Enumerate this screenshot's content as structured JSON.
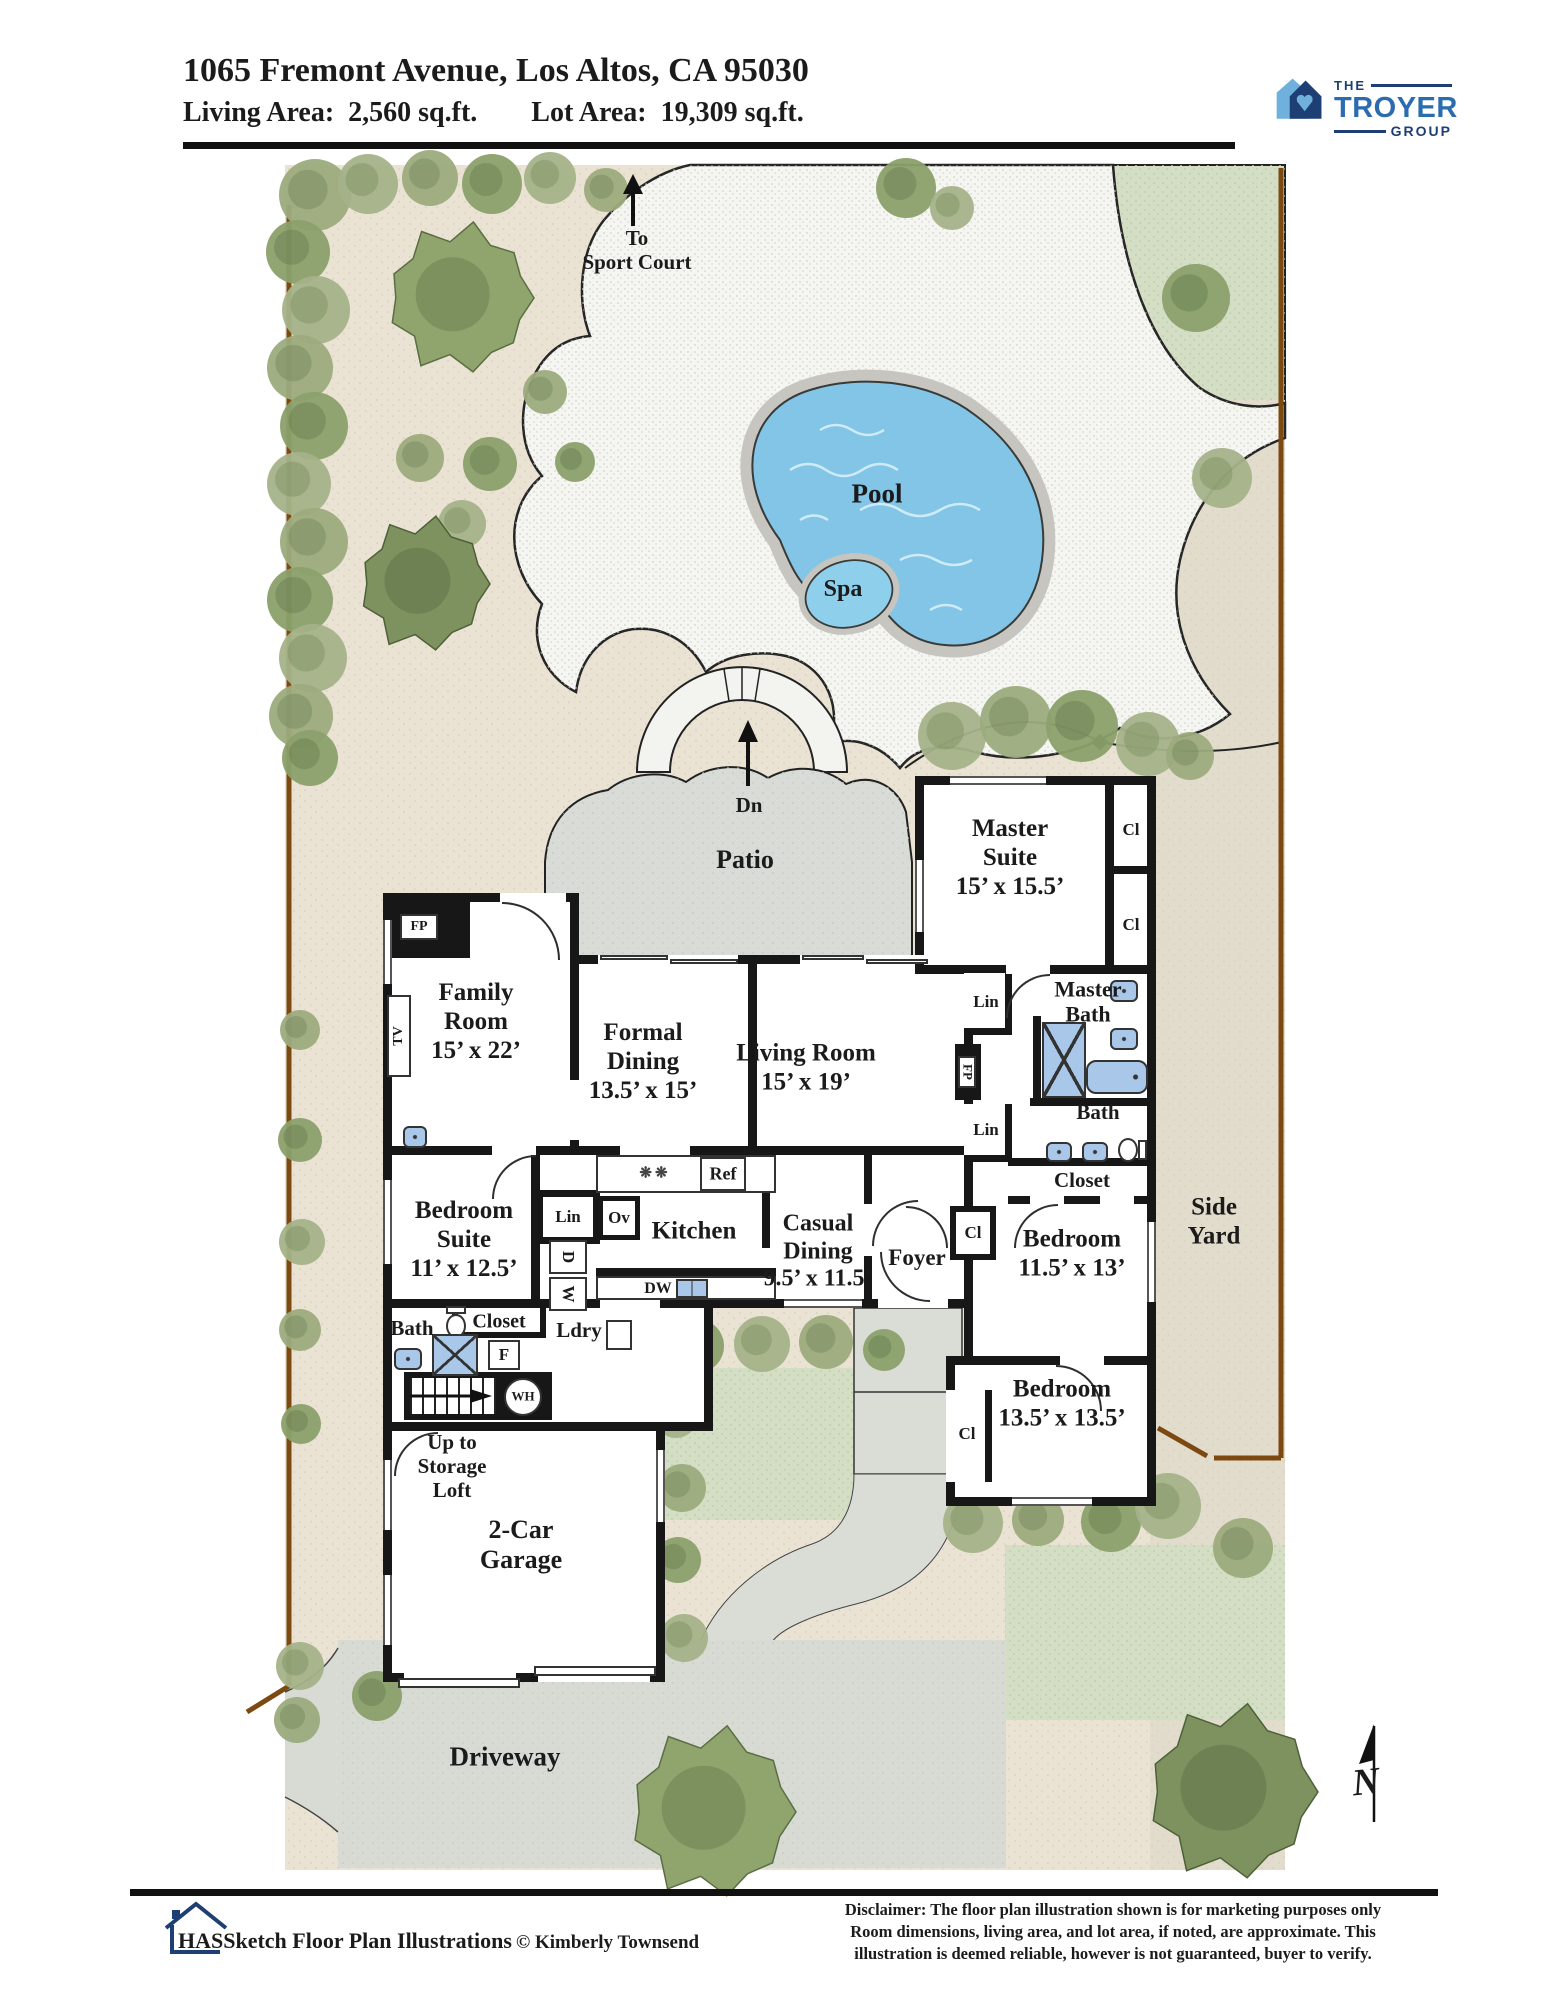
{
  "header": {
    "address": "1065 Fremont Avenue, Los Altos, CA 95030",
    "living_area_label": "Living Area:",
    "living_area_value": "2,560 sq.ft.",
    "lot_area_label": "Lot Area:",
    "lot_area_value": "19,309 sq.ft."
  },
  "logo": {
    "the": "THE",
    "troyer": "TROYER",
    "group": "GROUP"
  },
  "site": {
    "sport_court": "To\nSport Court",
    "pool": "Pool",
    "spa": "Spa",
    "patio": "Patio",
    "down": "Dn",
    "side_yard": "Side\nYard",
    "driveway": "Driveway",
    "north": "N"
  },
  "rooms": {
    "master_suite": "Master\nSuite\n15’ x 15.5’",
    "family_room": "Family\nRoom\n15’ x 22’",
    "formal_dining": "Formal\nDining\n13.5’ x 15’",
    "living_room": "Living Room\n15’ x 19’",
    "master_bath": "Master\nBath",
    "bedroom_1": "Bedroom\n11.5’ x 13’",
    "bedroom_2": "Bedroom\n13.5’ x 13.5’",
    "bedroom_suite": "Bedroom\nSuite\n11’ x 12.5’",
    "kitchen": "Kitchen",
    "casual_dining": "Casual\nDining\n9.5’ x 11.5’",
    "foyer": "Foyer",
    "laundry": "Ldry",
    "bath": "Bath",
    "closet": "Closet",
    "garage": "2-Car\nGarage",
    "storage_loft": "Up to\nStorage\nLoft"
  },
  "tags": {
    "cl": "Cl",
    "lin": "Lin",
    "fp": "FP",
    "tv": "TV",
    "ref": "Ref",
    "ov": "Ov",
    "washer": "W",
    "dryer": "D",
    "dw": "DW",
    "f": "F",
    "wh": "WH",
    "stove": "❋❋"
  },
  "colors": {
    "accent_blue_light": "#6fb0dc",
    "accent_blue_dark": "#1e3f74",
    "accent_blue_mid": "#2b6cb0",
    "pool_water": "#82c5e6",
    "lawn": "#d3dec5",
    "fence_brown": "#7c4a10"
  },
  "footer": {
    "brand": "HASSketch Floor Plan Illustrations",
    "copyright": "© Kimberly Townsend",
    "disclaimer": "Disclaimer: The floor plan illustration shown is for marketing purposes only\nRoom dimensions, living area, and lot area, if noted, are approximate. This\nillustration is deemed reliable, however is not guaranteed, buyer to verify."
  }
}
